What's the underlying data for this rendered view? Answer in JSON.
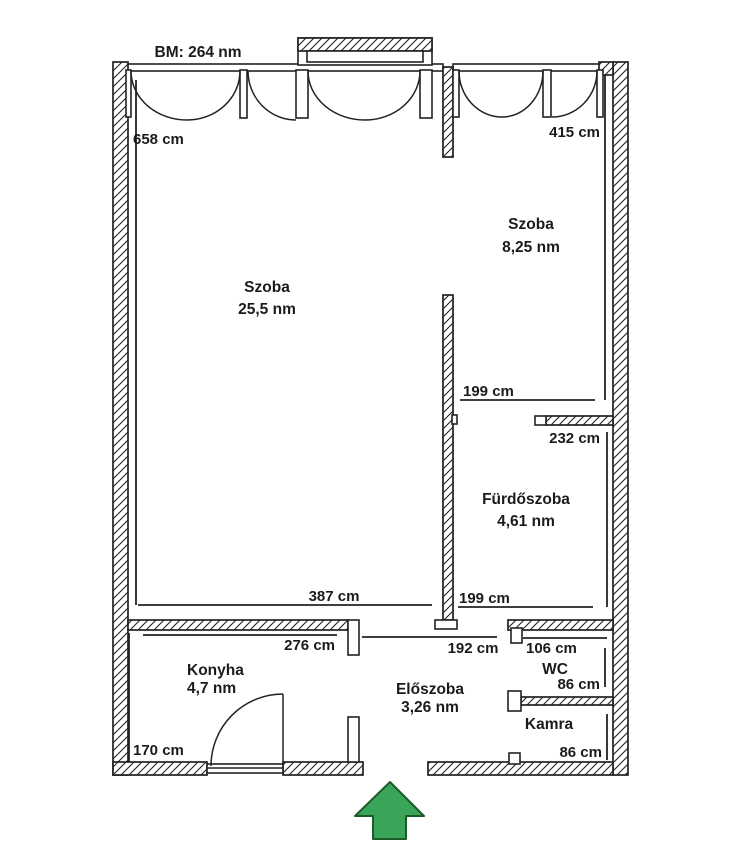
{
  "header": {
    "note": "BM: 264 nm"
  },
  "rooms": {
    "living": {
      "name": "Szoba",
      "area": "25,5 nm"
    },
    "bedroom": {
      "name": "Szoba",
      "area": "8,25 nm"
    },
    "bathroom": {
      "name": "Fürdőszoba",
      "area": "4,61 nm"
    },
    "kitchen": {
      "name": "Konyha",
      "area": "4,7 nm"
    },
    "hallway": {
      "name": "Előszoba",
      "area": "3,26 nm"
    },
    "wc": {
      "name": "WC"
    },
    "pantry": {
      "name": "Kamra"
    }
  },
  "dimensions": {
    "living_height": "658 cm",
    "bedroom_height": "415 cm",
    "bathroom_top_width": "199 cm",
    "bathroom_height": "232 cm",
    "living_width": "387 cm",
    "bathroom_bottom_width": "199 cm",
    "kitchen_width": "276 cm",
    "hallway_width": "192 cm",
    "wc_width": "106 cm",
    "wc_height": "86 cm",
    "pantry_height": "86 cm",
    "kitchen_height": "170 cm"
  },
  "entrance": {
    "symbol": "up-arrow",
    "fill_color": "#3aa558",
    "outline_color": "#1a5c28"
  }
}
